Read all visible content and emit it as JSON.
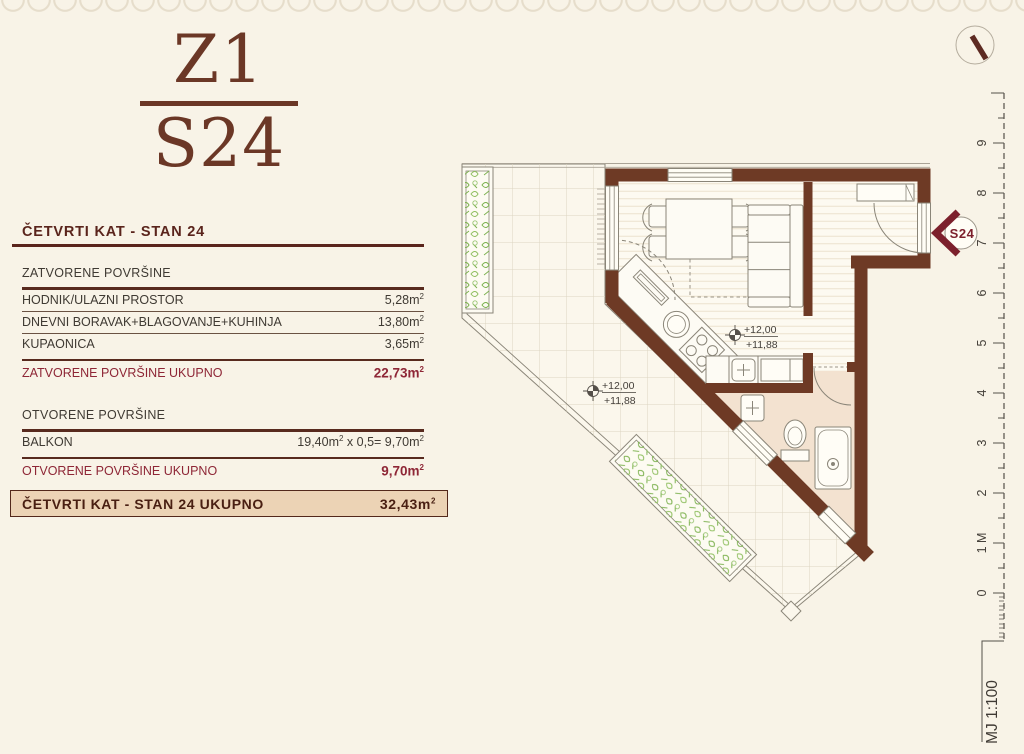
{
  "logo": {
    "top": "Z1",
    "bottom": "S24"
  },
  "header": {
    "title": "ČETVRTI KAT - STAN 24"
  },
  "units": {
    "m": "m",
    "sup": "2"
  },
  "closed": {
    "section": "ZATVORENE POVRŠINE",
    "rows": [
      {
        "label": "HODNIK/ULAZNI PROSTOR",
        "num": "5,28"
      },
      {
        "label": "DNEVNI BORAVAK+BLAGOVANJE+KUHINJA",
        "num": "13,80"
      },
      {
        "label": "KUPAONICA",
        "num": "3,65"
      }
    ],
    "total_label": "ZATVORENE POVRŠINE UKUPNO",
    "total_num": "22,73"
  },
  "open": {
    "section": "OTVORENE POVRŠINE",
    "balkon_label": "BALKON",
    "balkon_a": "19,40m",
    "balkon_b": " x 0,5= 9,70m",
    "total_label": "OTVORENE POVRŠINE UKUPNO",
    "total_num": "9,70"
  },
  "grand": {
    "label": "ČETVRTI KAT - STAN 24 UKUPNO",
    "num": "32,43"
  },
  "plan": {
    "badge": "S24",
    "elev_upper": "+12,00",
    "elev_lower": "+11,88",
    "scale": "MJ 1:100",
    "ruler": {
      "labels": [
        "9",
        "8",
        "7",
        "6",
        "5",
        "4",
        "3",
        "2",
        "1 M",
        "0"
      ]
    }
  },
  "colors": {
    "wall": "#6e3a25",
    "accent": "#8e2636",
    "rule": "#582a1e",
    "bath_floor": "#f3e2d0",
    "plant": "#7ab04c",
    "badge_red": "#7c202c",
    "box_bg": "#ecd3b5"
  }
}
